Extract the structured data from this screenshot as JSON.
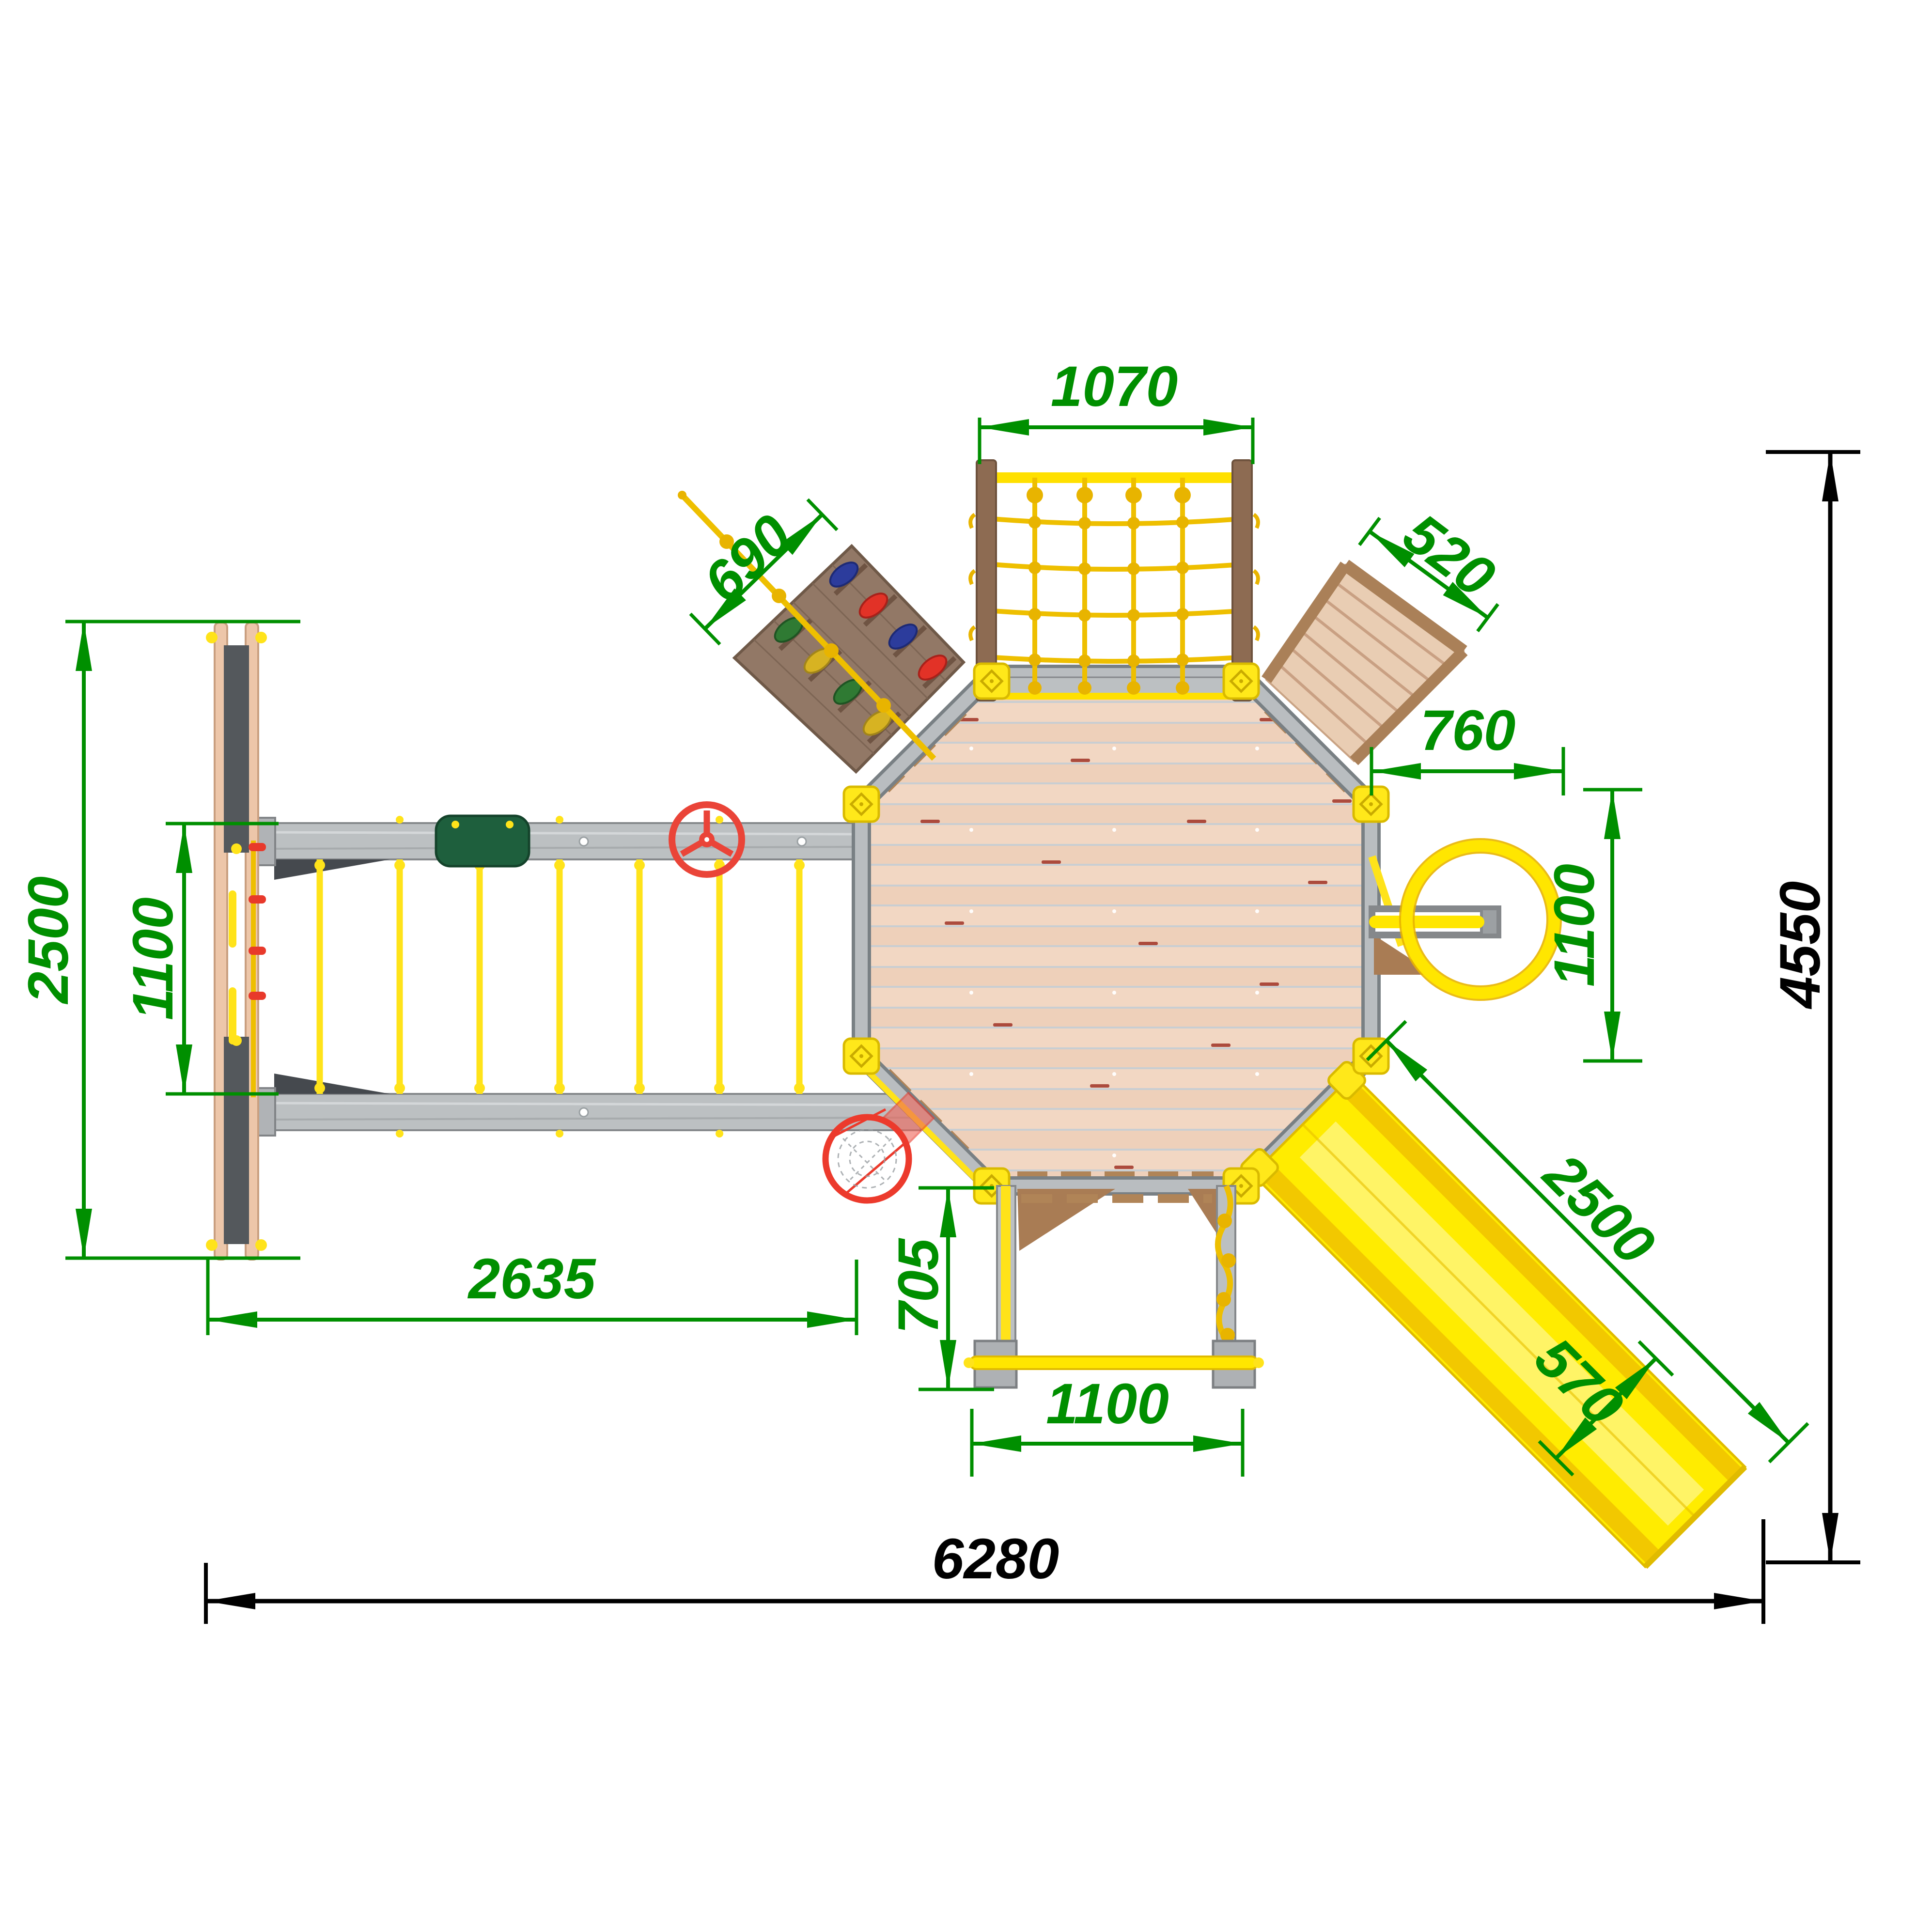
{
  "drawing": {
    "type": "playground-set-top-view-plan",
    "dims": {
      "net_width": "1070",
      "climbing_wall_width": "690",
      "stairs_width": "520",
      "ring_offset": "760",
      "right_edge_span": "1100",
      "slide_length": "2500",
      "slide_width": "570",
      "swing_frame_depth": "2500",
      "beam_gap": "1100",
      "monkey_bars_length": "2635",
      "pullup_bar_offset": "705",
      "pullup_bar_width": "1100",
      "overall_width": "6280",
      "overall_depth": "4550"
    },
    "colors": {
      "dimension_green": "#008f00",
      "dimension_black": "#000000",
      "accent_yellow": "#ffe31a",
      "rope_yellow": "#eebf00",
      "frame_gray": "#bcc0c2",
      "deck_wood": "#f2d7c3",
      "panel_brown": "#927866",
      "detail_red": "#ea4438",
      "seat_green": "#1e5f3d"
    }
  }
}
